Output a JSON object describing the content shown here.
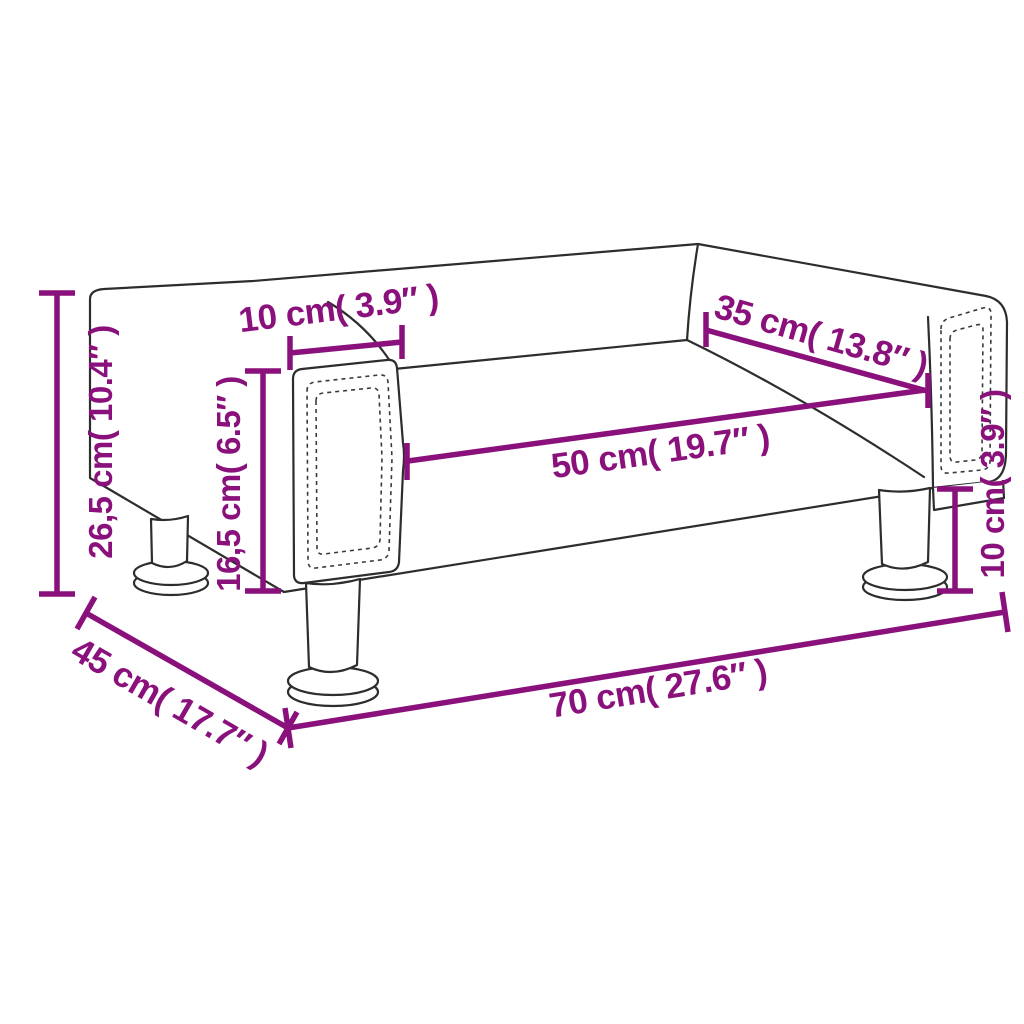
{
  "diagram": {
    "kind": "product-dimension-diagram",
    "accent_color": "#8A117C",
    "outline_color": "#2D2D2D",
    "background_color": "#FFFFFF",
    "labels": {
      "total_height": "26,5 cm( 10.4″ )",
      "armrest_height": "16,5 cm( 6.5″ )",
      "armrest_width": "10 cm( 3.9″ )",
      "backrest_depth": "35 cm( 13.8″ )",
      "seat_width": "50 cm( 19.7″ )",
      "leg_height": "10 cm( 3.9″ )",
      "total_depth": "45 cm( 17.7″ )",
      "total_width": "70 cm( 27.6″ )"
    }
  }
}
